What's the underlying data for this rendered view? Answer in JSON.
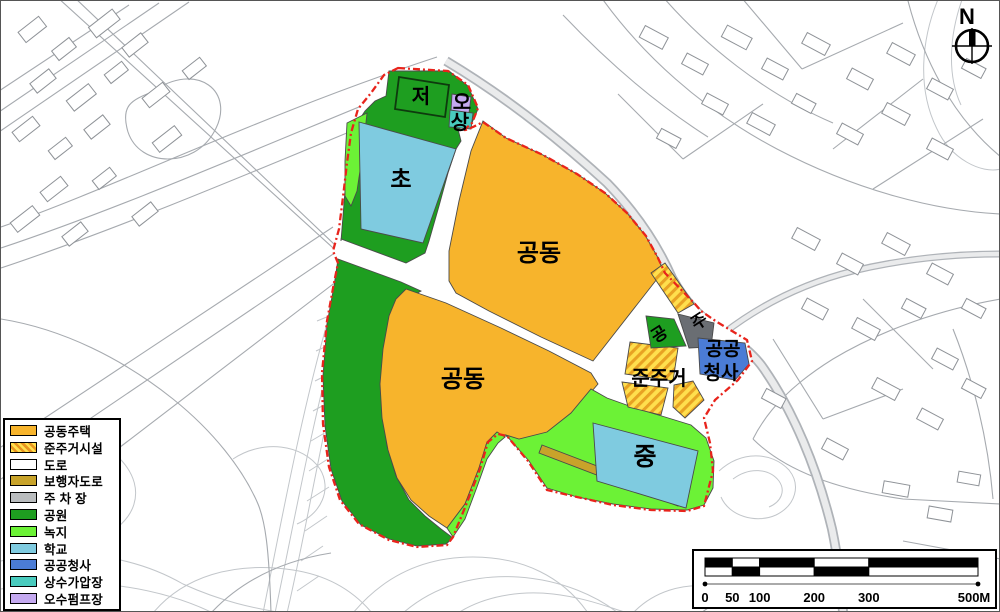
{
  "map": {
    "north_label": "N",
    "zone_labels": {
      "detention": "저",
      "sewage_pump": "오",
      "water_booster": "상",
      "elementary_school": "초",
      "apartment_top": "공동",
      "apartment_bottom": "공동",
      "small_park": "공",
      "parking": "주",
      "public_office_line1": "공공",
      "public_office_line2": "청사",
      "semi_residential": "준주거",
      "middle_school": "중"
    }
  },
  "legend": {
    "items": [
      {
        "label": "공동주택",
        "color": "#F7B42C",
        "pattern": "solid"
      },
      {
        "label": "준주거시설",
        "color": "#FFDF4D",
        "pattern": "hatch"
      },
      {
        "label": "도로",
        "color": "#FFFFFF",
        "pattern": "solid"
      },
      {
        "label": "보행자도로",
        "color": "#C8A32A",
        "pattern": "solid"
      },
      {
        "label": "주 차 장",
        "color": "#B9BCBE",
        "pattern": "solid"
      },
      {
        "label": "공원",
        "color": "#1E9E20",
        "pattern": "solid"
      },
      {
        "label": "녹지",
        "color": "#6CF236",
        "pattern": "solid"
      },
      {
        "label": "학교",
        "color": "#7FCBE0",
        "pattern": "solid"
      },
      {
        "label": "공공청사",
        "color": "#4B7CD6",
        "pattern": "solid"
      },
      {
        "label": "상수가압장",
        "color": "#49CBBE",
        "pattern": "solid"
      },
      {
        "label": "오수펌프장",
        "color": "#C4A9F0",
        "pattern": "solid"
      }
    ]
  },
  "scale_bar": {
    "ticks": [
      "0",
      "50",
      "100",
      "200",
      "300",
      "500M"
    ]
  },
  "colors": {
    "boundary_red": "#E8241C",
    "apartment_orange": "#F7B42C",
    "semi_residential_hatch": "#E8A223",
    "pedestrian_road": "#C8A32A",
    "parking_gray": "#6A6E73",
    "park_green": "#1E9E20",
    "greenbelt": "#6CF236",
    "school_blue": "#7FCBE0",
    "public_office_blue": "#4B7CD6",
    "water_teal": "#49CBBE",
    "sewage_purple": "#C4A9F0"
  }
}
